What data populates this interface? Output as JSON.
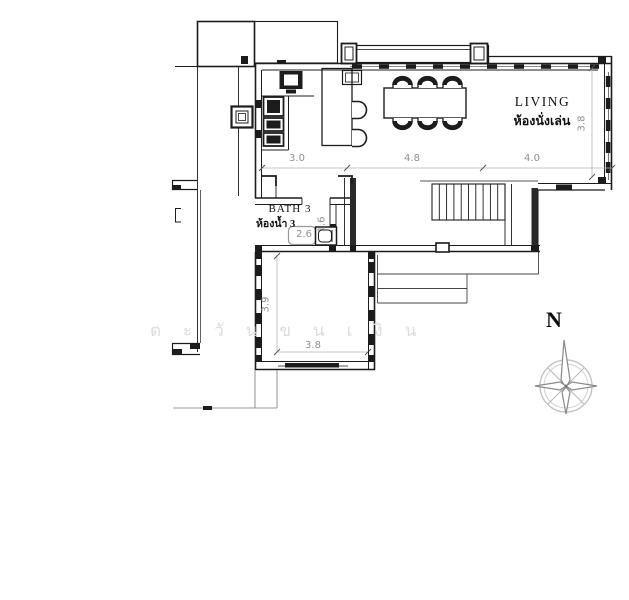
{
  "plan": {
    "rooms": {
      "living": {
        "label_en": "LIVING",
        "label_th": "ห้องนั่งเล่น"
      },
      "bath3": {
        "label_en": "BATH 3",
        "label_th": "ห้องน้ำ 3"
      }
    },
    "dimensions": {
      "top_row": [
        "3.0",
        "4.8",
        "4.0"
      ],
      "living_depth": "3.8",
      "bath_width": "2.6",
      "bath_depth": "1.6",
      "lower_room_depth": "3.9",
      "lower_room_width": "3.8"
    },
    "compass": {
      "north": "N"
    },
    "watermark_letters": [
      "ต",
      "ะ",
      "วั",
      "น",
      "ข",
      "น",
      "เ",
      "งิ",
      "น"
    ],
    "colors": {
      "line": "#1c1c1c",
      "dim_text": "#8f8f8f",
      "dim_line": "#b5b5b5",
      "watermark": "#dcdcdc"
    }
  }
}
